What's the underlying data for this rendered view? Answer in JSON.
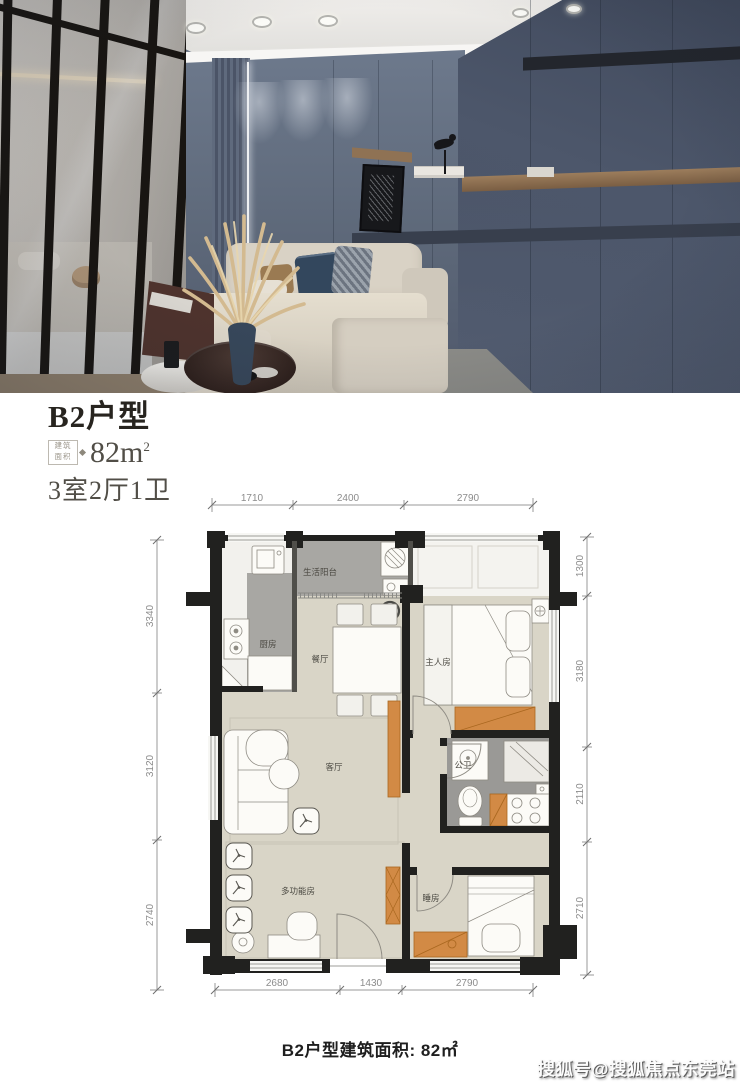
{
  "hero": {
    "colors": {
      "accent_wall": "#5c6779",
      "cabinet_wall": "#4a5466",
      "sofa_beige": "#d8d1c4",
      "shelf_wood": "#8f7254"
    }
  },
  "listing": {
    "title": "B2户型",
    "area_box_line1": "建筑",
    "area_box_line2": "面积",
    "area_value": "82m",
    "area_sup": "2",
    "rooms_summary": "3室2厅1卫"
  },
  "floor_plan": {
    "dims_top": [
      "1710",
      "2400",
      "2790"
    ],
    "dims_bottom": [
      "2680",
      "1430",
      "2790"
    ],
    "dims_left": [
      "3340",
      "3120",
      "2740"
    ],
    "dims_right": [
      "1300",
      "3180",
      "2110",
      "2710"
    ],
    "rooms": {
      "balcony": "生活阳台",
      "kitchen": "厨房",
      "dining": "餐厅",
      "master": "主人房",
      "living": "客厅",
      "bath": "公卫",
      "multi": "多功能房",
      "bedroom": "睡房"
    },
    "colors": {
      "floor_beige": "#d9d5c7",
      "floor_gray": "#a8a7a3",
      "wall": "#21211f",
      "cabinet_orange": "#d28a45"
    }
  },
  "caption": {
    "text": "B2户型建筑面积: 82㎡"
  },
  "watermark": {
    "text": "搜狐号@搜狐焦点东莞站"
  }
}
